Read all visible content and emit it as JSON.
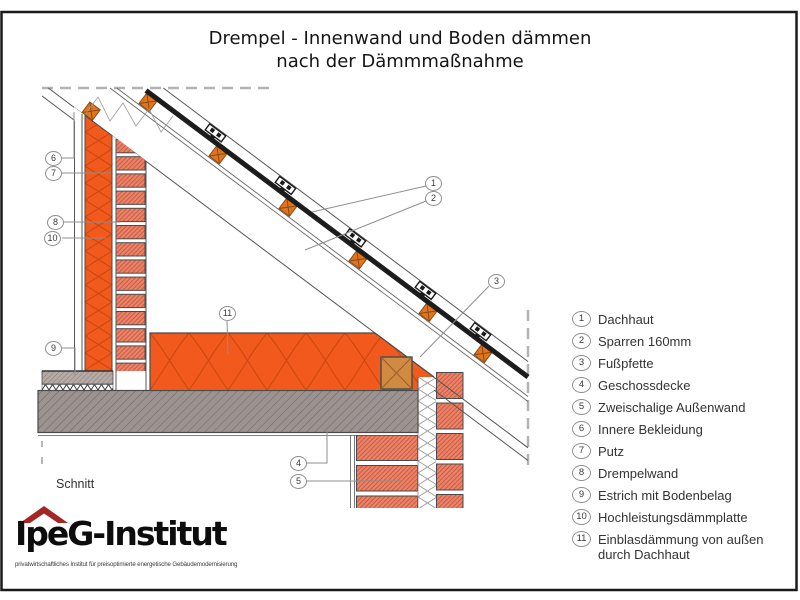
{
  "title": {
    "line1": "Drempel - Innenwand und Boden dämmen",
    "line2": "nach der Dämmmaßnahme"
  },
  "legend": {
    "items": [
      {
        "num": "1",
        "label": "Dachhaut"
      },
      {
        "num": "2",
        "label": "Sparren 160mm"
      },
      {
        "num": "3",
        "label": "Fußpfette"
      },
      {
        "num": "4",
        "label": "Geschossdecke"
      },
      {
        "num": "5",
        "label": "Zweischalige Außenwand"
      },
      {
        "num": "6",
        "label": "Innere Bekleidung"
      },
      {
        "num": "7",
        "label": "Putz"
      },
      {
        "num": "8",
        "label": "Drempelwand"
      },
      {
        "num": "9",
        "label": "Estrich mit Bodenbelag"
      },
      {
        "num": "10",
        "label": "Hochleistungsdämmplatte"
      },
      {
        "num": "11",
        "label": "Einblasdämmung von außen durch Dachhaut"
      }
    ]
  },
  "drawing": {
    "section_label": "Schnitt"
  },
  "logo": {
    "wordmark": "IpeG-Institut",
    "tagline": "privatwirtschaftliches Institut für preisoptimierte energetische Gebäudemodernisierung"
  },
  "colors": {
    "insulation_orange": "#F2591C",
    "brick_salmon": "#EC8166",
    "wood_tan": "#D08A42",
    "batten_orange": "#E0751C",
    "slab_gray": "#9C9391",
    "logo_red": "#A32623",
    "line_dark": "#4a4a4a"
  }
}
